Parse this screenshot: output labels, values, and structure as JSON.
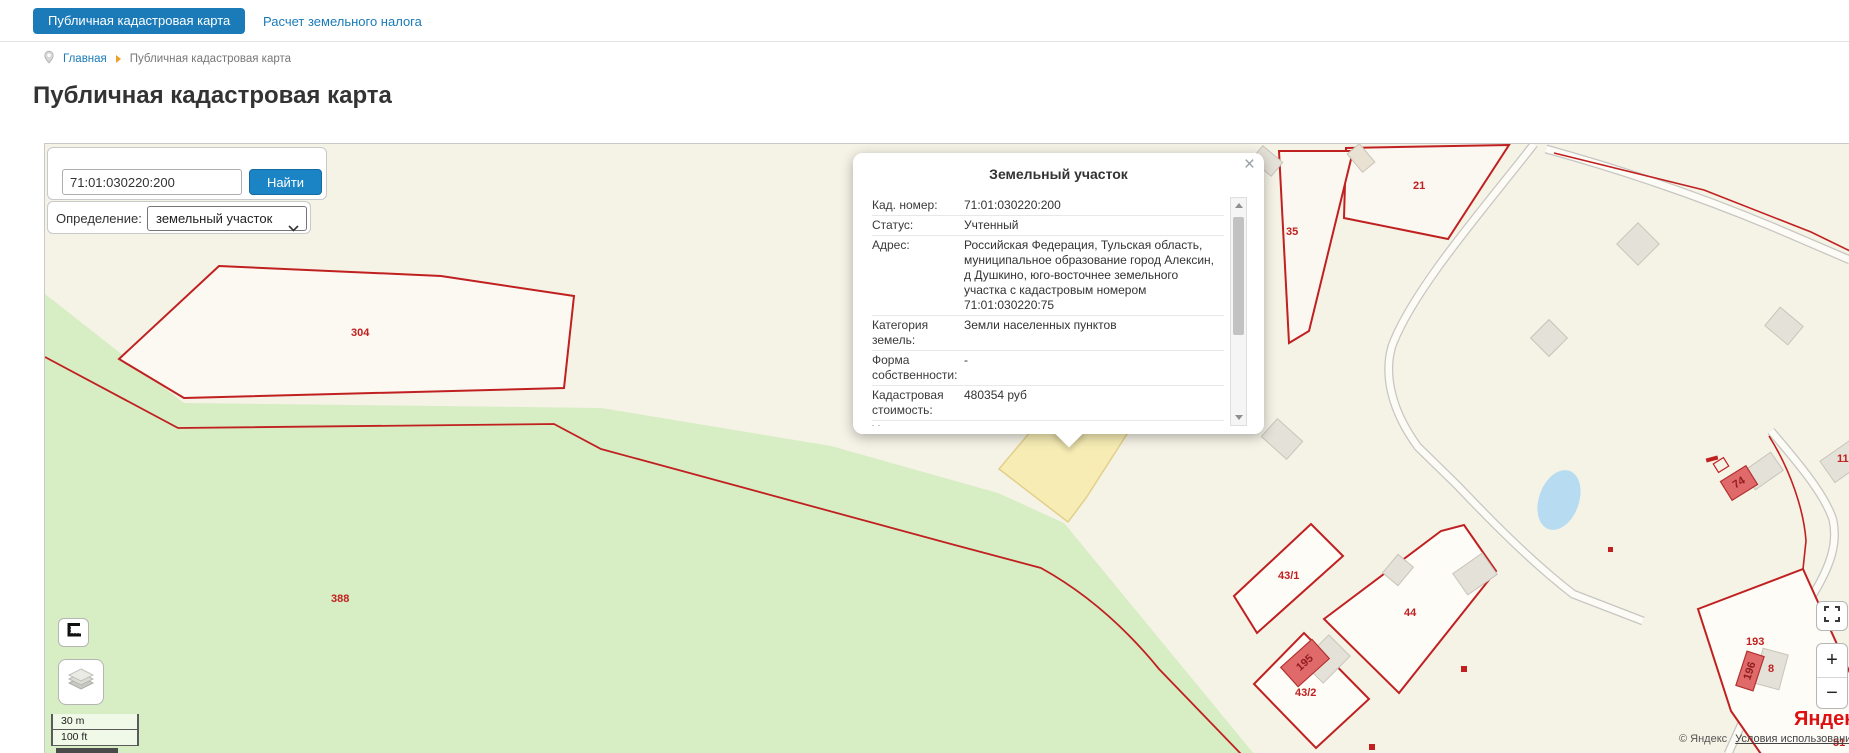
{
  "tabs": {
    "active": "Публичная кадастровая карта",
    "secondary": "Расчет земельного налога"
  },
  "breadcrumb": {
    "home": "Главная",
    "current": "Публичная кадастровая карта"
  },
  "page": {
    "title": "Публичная кадастровая карта"
  },
  "search": {
    "value": "71:01:030220:200",
    "button": "Найти",
    "filter_label": "Определение:",
    "filter_value": "земельный участок"
  },
  "popup": {
    "title": "Земельный участок",
    "close": "×",
    "rows": [
      {
        "label": "Кад. номер:",
        "value": "71:01:030220:200"
      },
      {
        "label": "Статус:",
        "value": "Учтенный"
      },
      {
        "label": "Адрес:",
        "value": "Российская Федерация, Тульская область, муниципальное образование город Алексин, д Душкино, юго-восточнее земельного участка с кадастровым номером 71:01:030220:75"
      },
      {
        "label": "Категория земель:",
        "value": "Земли населенных пунктов"
      },
      {
        "label": "Форма собственности:",
        "value": "-"
      },
      {
        "label": "Кадастровая стоимость:",
        "value": "480354 руб"
      },
      {
        "label": "Уточненная",
        "value": ""
      }
    ]
  },
  "map": {
    "parcel_labels": [
      {
        "text": "304"
      },
      {
        "text": "388"
      },
      {
        "text": "21"
      },
      {
        "text": "35"
      },
      {
        "text": "43/1"
      },
      {
        "text": "44"
      },
      {
        "text": "43/2"
      },
      {
        "text": "193"
      },
      {
        "text": "195"
      },
      {
        "text": "196"
      },
      {
        "text": "8"
      },
      {
        "text": "74"
      },
      {
        "text": "11"
      },
      {
        "text": "51"
      }
    ],
    "controls": {
      "zoom_in": "+",
      "zoom_out": "−"
    },
    "scale": {
      "metric": "30 m",
      "imperial": "100 ft"
    },
    "attribution": {
      "logo": "Яндекс",
      "copyright": "© Яндекс",
      "terms": "Условия использования"
    },
    "colors": {
      "accent": "#1a7bb8",
      "parcel_line": "#c02020",
      "selected_fill": "#f6ecb4",
      "vegetation": "#d7edc3",
      "water": "#b7dcf2",
      "background": "#f5f2e6"
    }
  }
}
